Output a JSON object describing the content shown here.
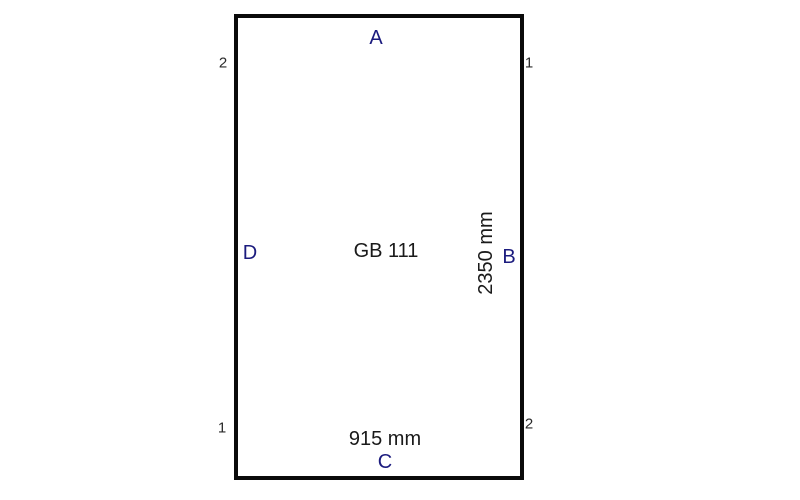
{
  "diagram": {
    "product_code": "GB 111",
    "width_label": "915 mm",
    "height_label": "2350 mm",
    "edges": {
      "top": "A",
      "right": "B",
      "bottom": "C",
      "left": "D"
    },
    "corners": {
      "top_left": "2",
      "top_right": "1",
      "bottom_left": "1",
      "bottom_right": "2"
    },
    "colors": {
      "edge_label": "#1b1b7e",
      "dimension_text": "#1a1a1a",
      "corner_text": "#2a2a2a",
      "outline": "#0a0a0a",
      "background": "#ffffff"
    }
  }
}
